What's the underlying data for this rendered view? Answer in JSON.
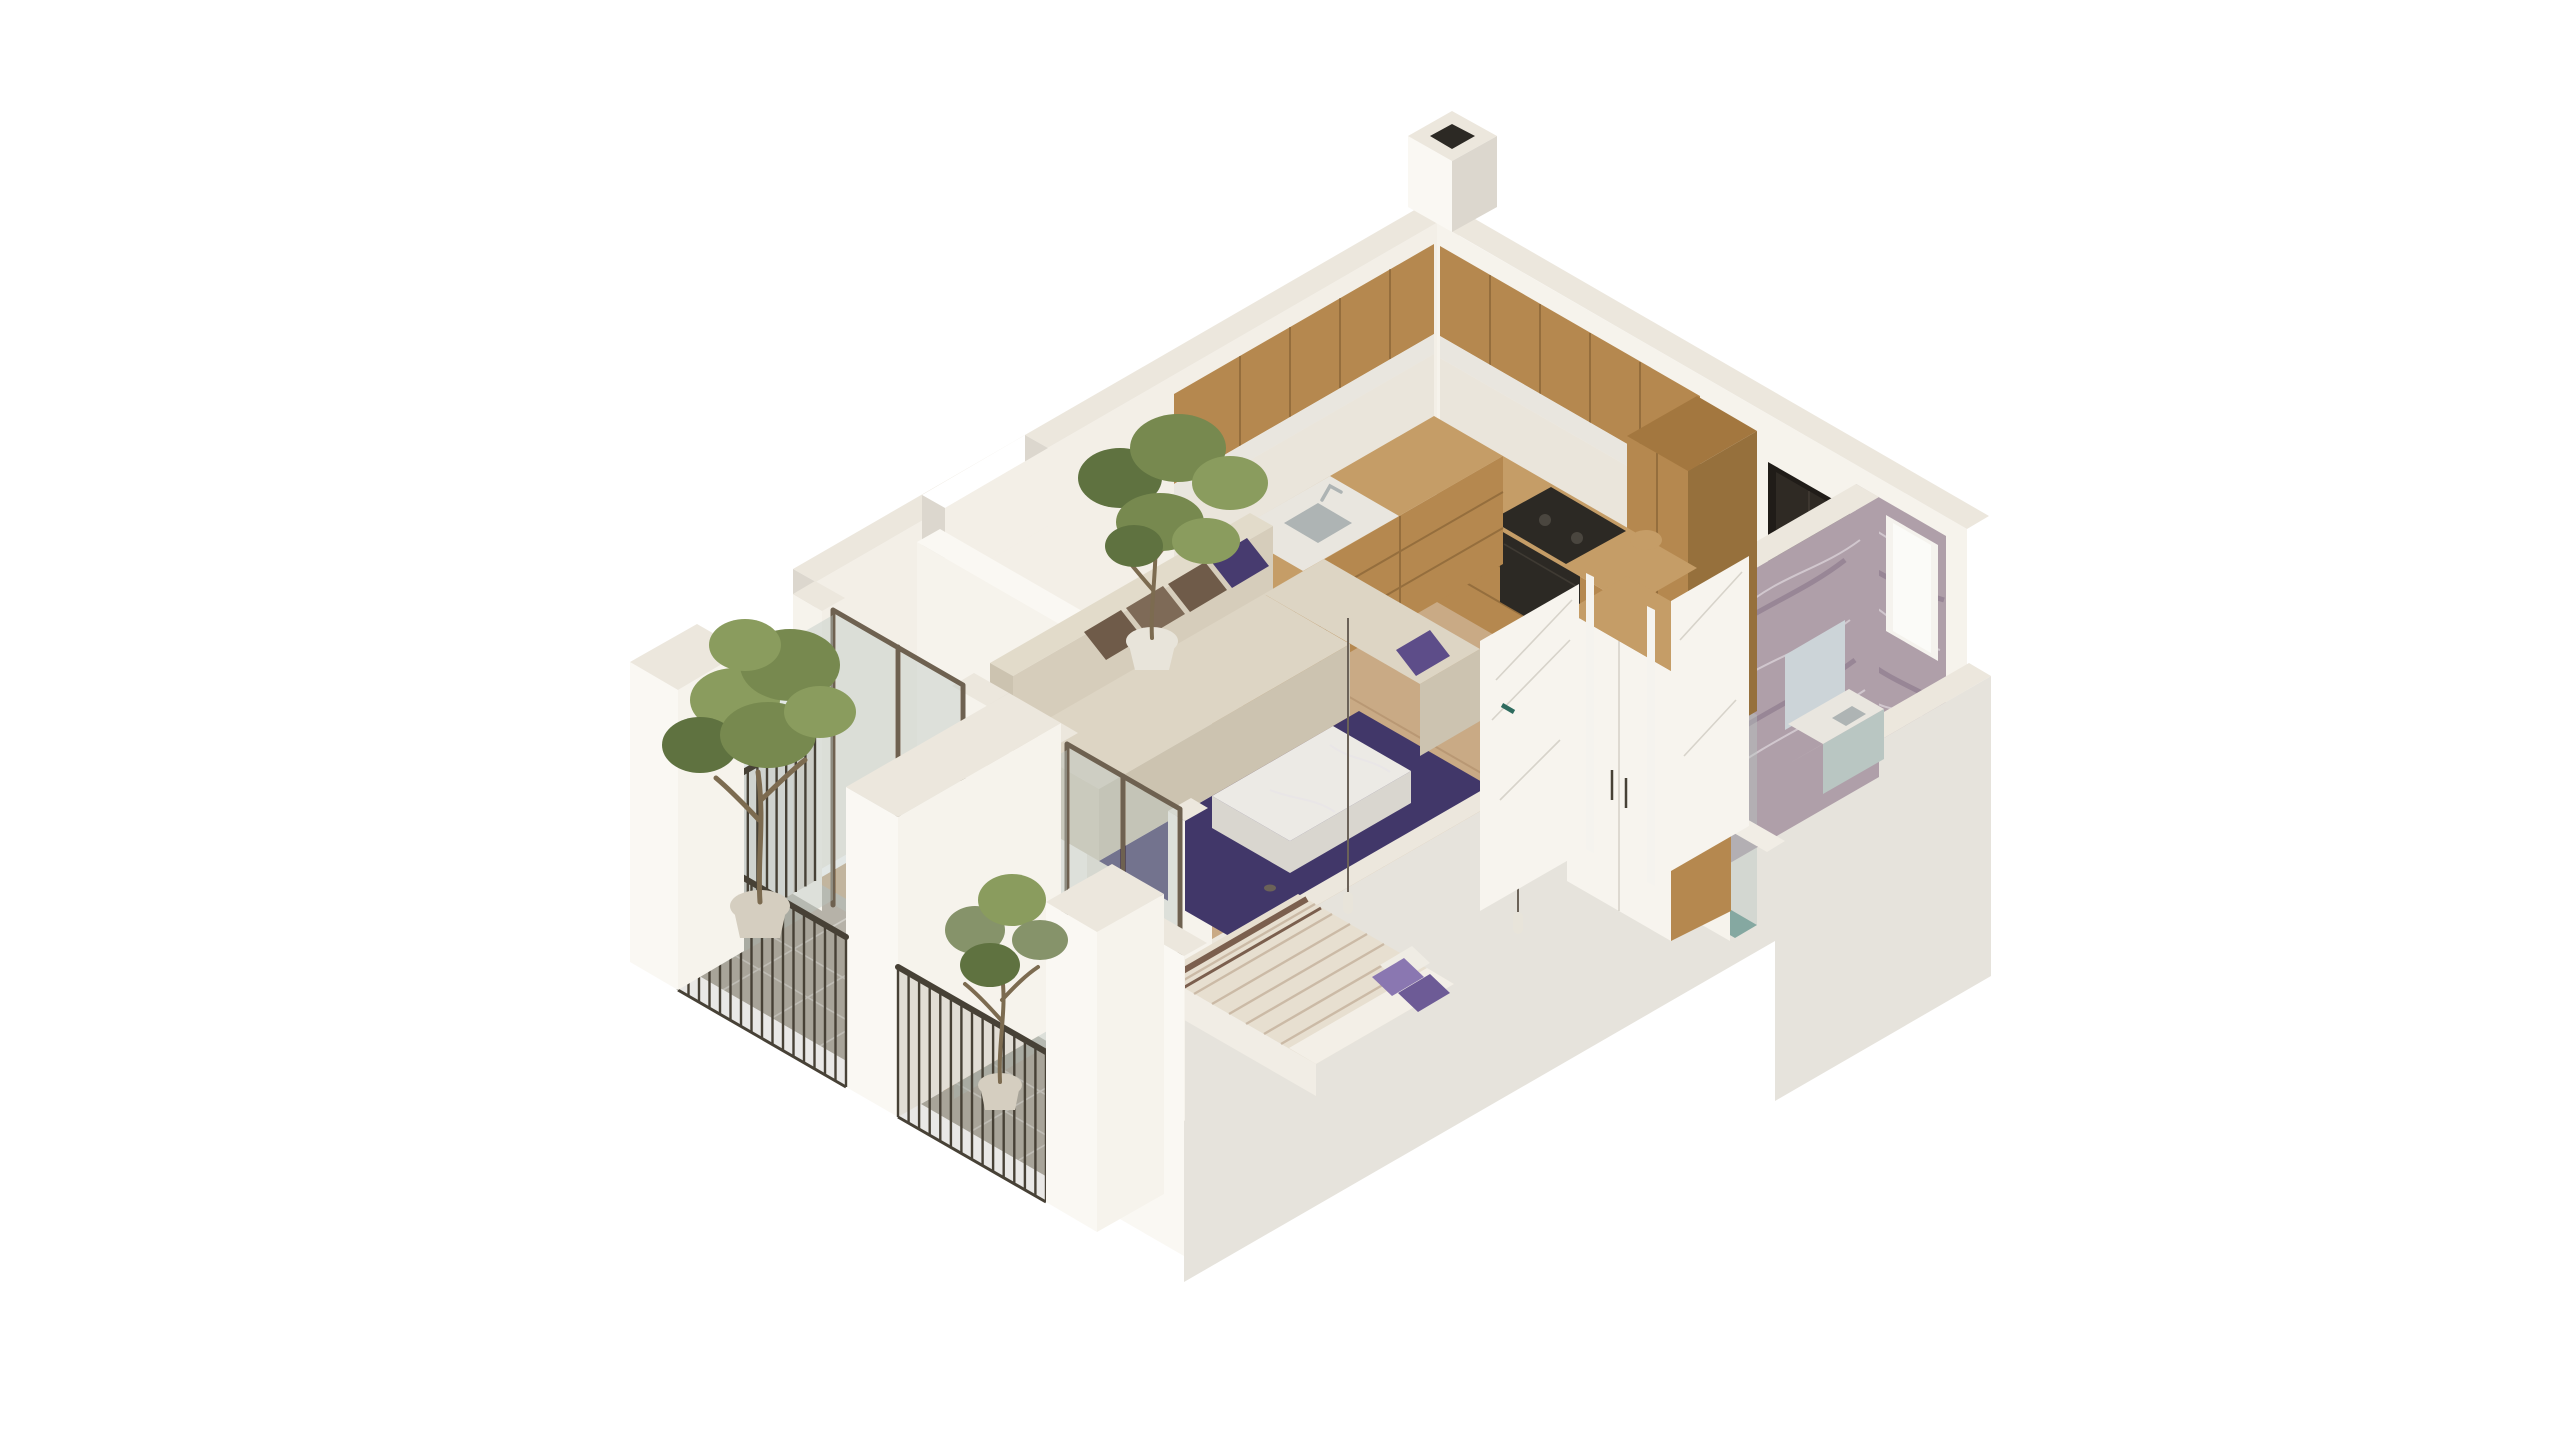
{
  "scene": {
    "description": "Isometric 3D cutaway rendering of a one-bedroom apartment floor plan on a white background: open living room with L-shaped beige sofa, purple rug and marble coffee table, wooden L-shaped kitchen along the two top walls, entry hall with dark front door, marble-tiled bathroom with vanity and glass shower in the right corner, bedroom with double bed and wardrobe at the bottom, and two lower-left balconies with dark metal railings, glass doors and potted trees.",
    "rooms": [
      "living-room",
      "kitchen",
      "entry-hall",
      "bathroom",
      "bedroom",
      "balcony-living",
      "balcony-bedroom"
    ],
    "objects": [
      "sofa",
      "brown-pillows",
      "purple-pillows",
      "purple-rug",
      "marble-coffee-table",
      "indoor-ficus-plant",
      "kitchen-base-cabinets",
      "kitchen-upper-cabinets",
      "kitchen-sink",
      "kitchen-faucet",
      "cooktop",
      "oven",
      "tall-cabinet",
      "round-cutting-board",
      "entry-door",
      "bathroom-window",
      "bathroom-marble-walls",
      "vanity",
      "mirror",
      "shower-glass",
      "towel",
      "bed",
      "bed-purple-pillows",
      "pendant-lamps",
      "wardrobe",
      "bedroom-door",
      "bathroom-door",
      "balcony-railings",
      "balcony-glass-doors",
      "olive-tree",
      "small-tree",
      "chimney-vent"
    ]
  },
  "palette": {
    "bg": "#ffffff",
    "wallTop": "#ece7dd",
    "wallTopLight": "#f1ece2",
    "wallInnerWarm": "#f3efe7",
    "wallInnerLight": "#f6f3ec",
    "wallBright": "#faf8f3",
    "wallFace2": "#eae5db",
    "wallOuterLight": "#e6e3dc",
    "wallOuterShade": "#dcd7ce",
    "woodFloor": "#c9aa85",
    "plankLine": "rgba(128,92,58,0.22)",
    "tileBalcony": "#b6b2a8",
    "tileBath": "#a3b1ae",
    "groutLine": "rgba(255,255,255,0.35)",
    "marbleWall": "#af9fa9",
    "marbleVein": "#e8e2e8",
    "marbleVeinDark": "#6d5a73",
    "woodCab": "#b5884f",
    "woodCabDark": "#a3773f",
    "woodCabDark2": "#96703c",
    "woodCabLight": "#c59d67",
    "counterWhite": "#e9e6df",
    "cooktopDark": "#2c2924",
    "steel": "#aeb4b4",
    "sofaTop": "#e2dbca",
    "sofaTop2": "#ddd5c4",
    "sofaBase": "#d6cdbb",
    "sofaFront": "#ccc3b0",
    "pillowBrown": "#6f5b49",
    "pillowBrown2": "#7e6a57",
    "pillowPurple": "#473b6f",
    "pillowPurple2": "#5d4d89",
    "rugPurple": "#413769",
    "marbleTable": "#eceae5",
    "marbleTableSide": "#d9d6cf",
    "bedTop": "#e7dfd0",
    "bedStripe": "rgba(158,126,96,0.38)",
    "bedDarkStripe": "#7b5f4e",
    "bedBase": "#f1ede5",
    "bedFold": "#f3efe7",
    "pillowBedPurple": "#8a77b1",
    "pillowBedPurple2": "#6d5b96",
    "pillowBedWhite": "#efece4",
    "potBeige": "#d5cec0",
    "potWhite": "#e8e4da",
    "trunkBrown": "#7c6b50",
    "plantGreen": "#77894f",
    "plantGreen2": "#8a9c5e",
    "plantDark": "#5f7240",
    "plantMuted": "#86936a",
    "glassPane": "rgba(186,198,192,0.42)",
    "bronze": "#6e6150",
    "railDark": "#474136",
    "railShade": "rgba(70,62,52,0.12)",
    "showerTeal": "#85a8a1",
    "vanityTeal": "#b9c6c2",
    "mirrorBlue": "#ccd4d8",
    "doorDark": "#2f2a24",
    "doorFrameDark": "#201c18",
    "leafWhite": "#f7f4ee",
    "windowFrame": "#f5f3ee",
    "windowPane": "#fbfbf8",
    "cordGray": "#6b6258",
    "seamBrown": "rgba(90,62,30,0.35)",
    "seamLight": "rgba(120,110,95,0.25)"
  }
}
